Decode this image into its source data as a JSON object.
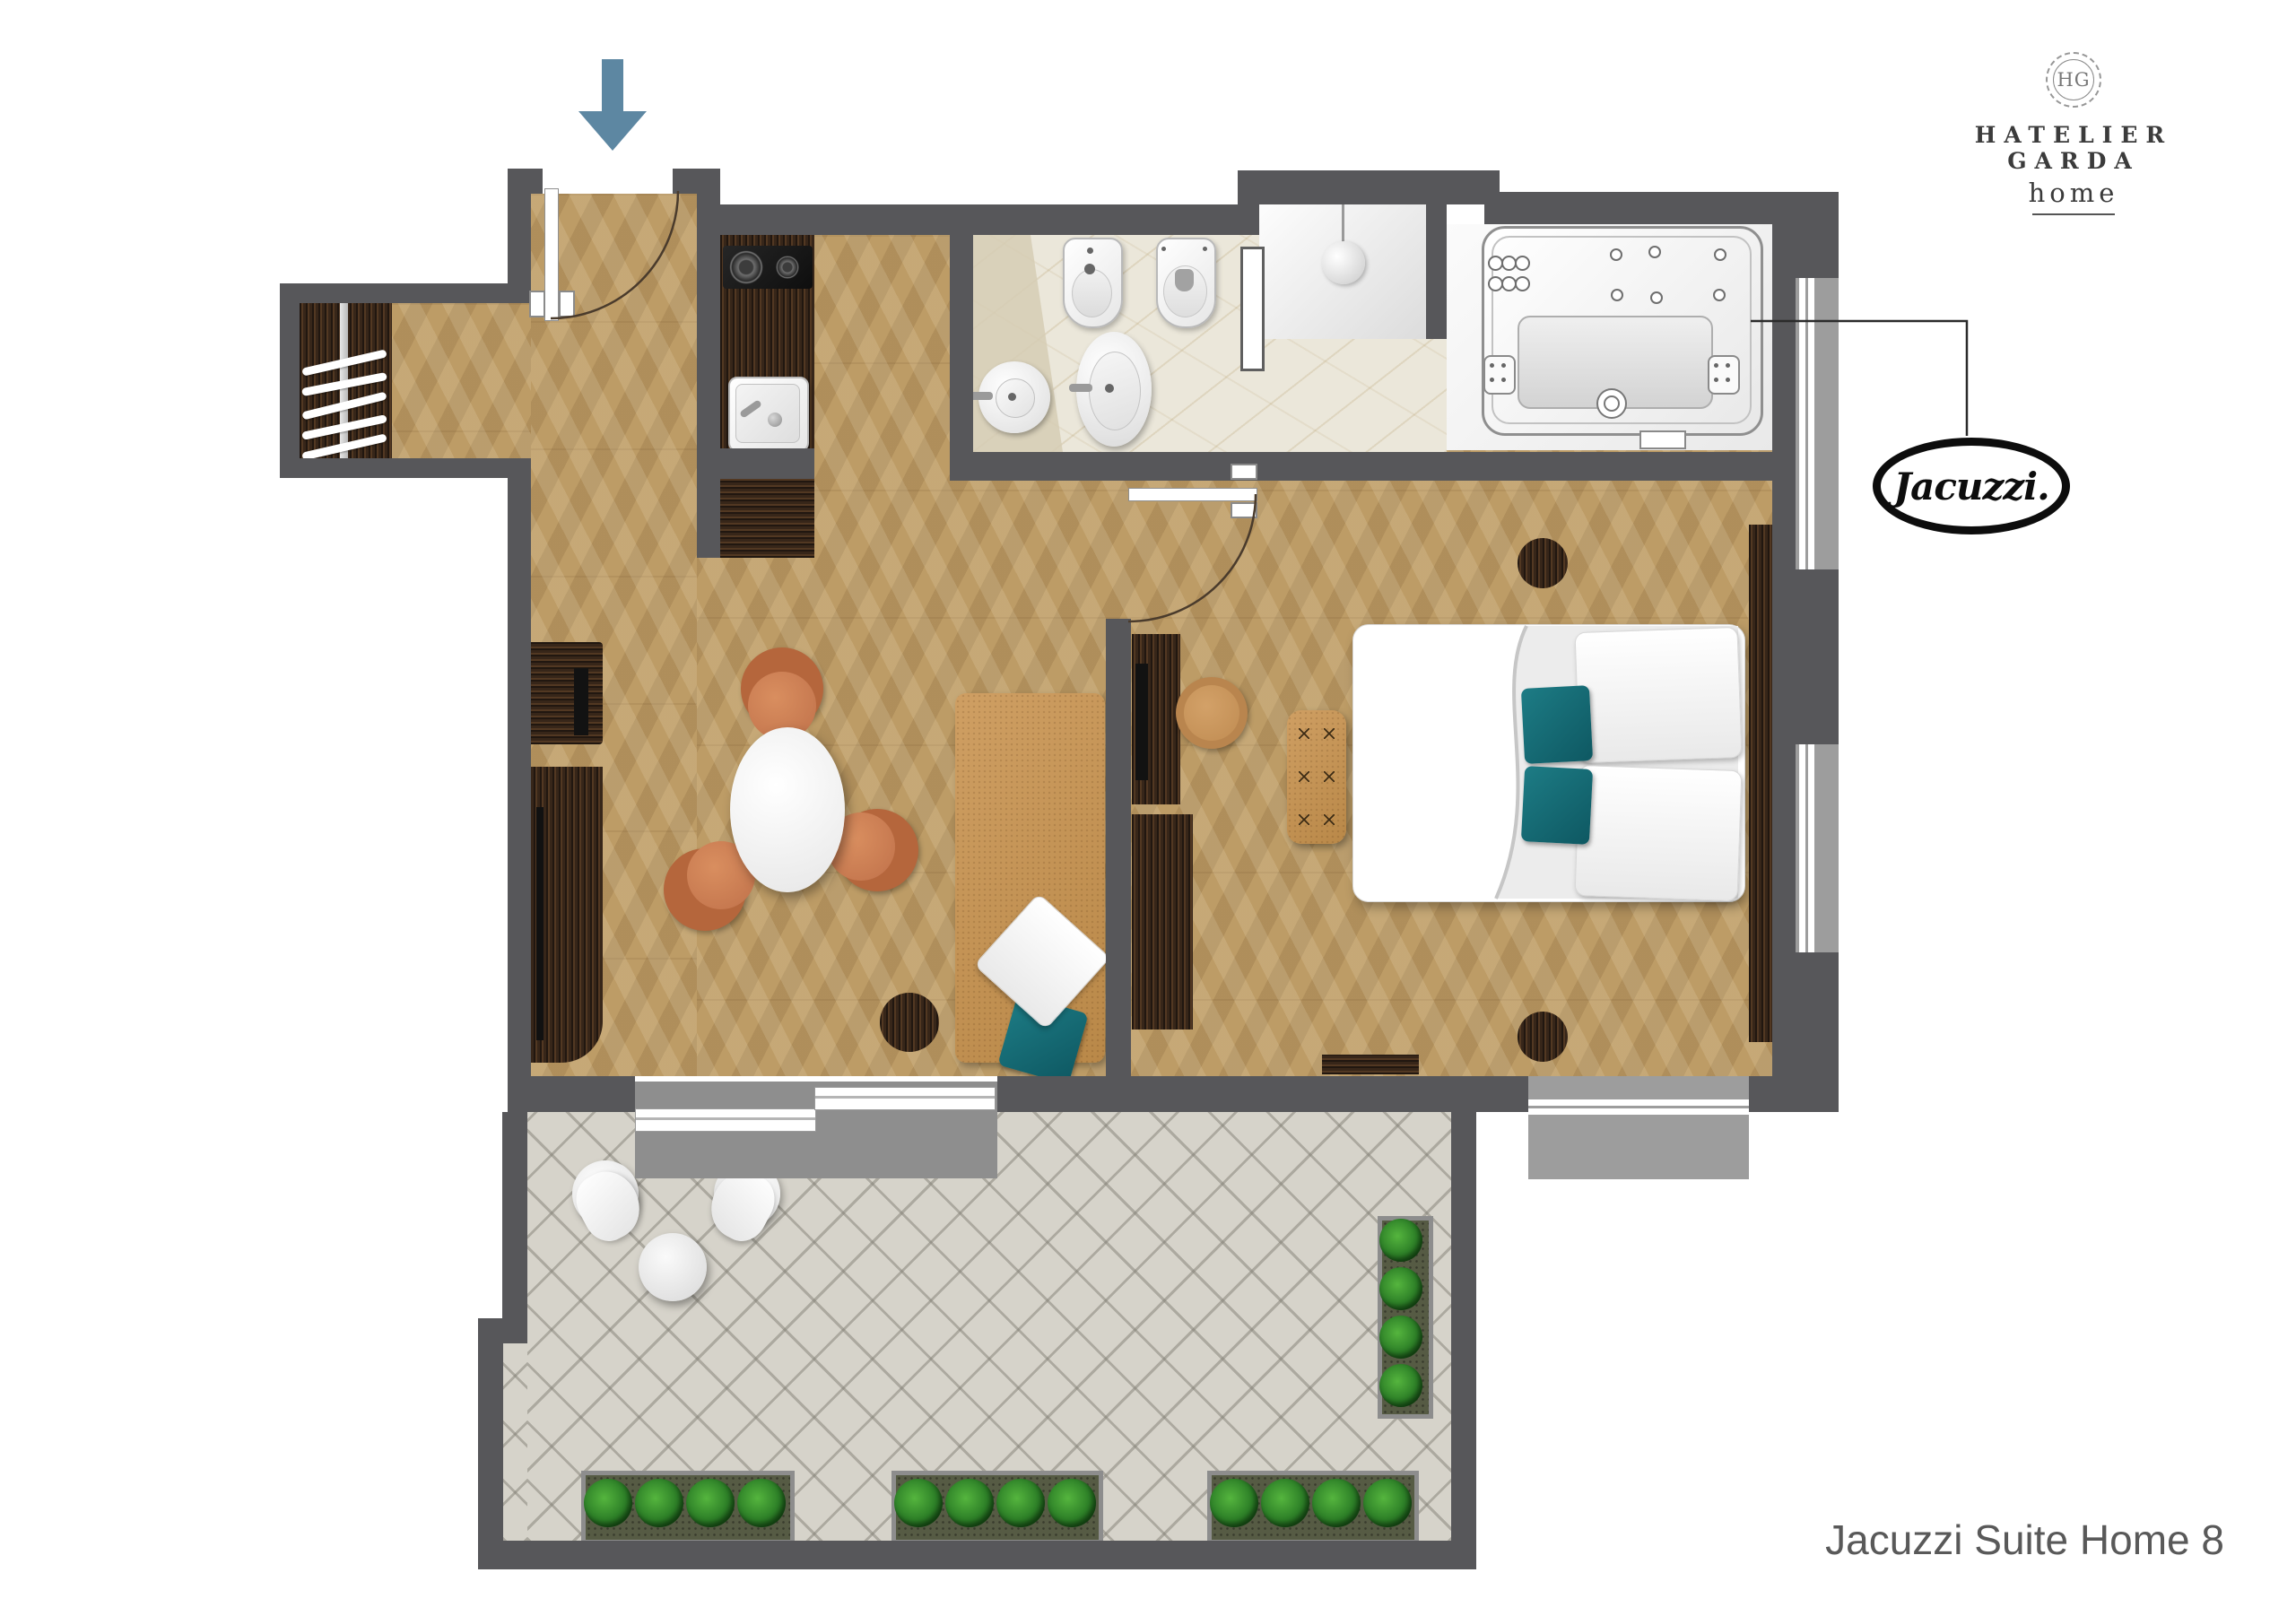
{
  "branding": {
    "monogram": "HG",
    "name": "HATELIER GARDA",
    "tagline": "home"
  },
  "jacuzzi_logo": {
    "text": "Jacuzzi."
  },
  "caption": {
    "text": "Jacuzzi Suite Home 8"
  },
  "icons": {
    "entrance_arrow": "arrow-down",
    "shower_head": "shower-head",
    "coat_hanger": "hanger"
  },
  "colors": {
    "wall": "#57575a",
    "wall_light": "#8e8e8e",
    "window_sill": "#9d9d9d",
    "wood_floor": "#bd9c66",
    "dark_wood": "#35251a",
    "marble": "#ebe7da",
    "terrace_tile": "#d6d3ca",
    "terracotta_chair": "#c0714a",
    "tan_leather": "#c79a5f",
    "teal_pillow": "#166b76",
    "plant_green": "#2e8128",
    "entrance_arrow_blue": "#5d87a2",
    "brand_text": "#3b3b3b",
    "caption_text": "#595959",
    "jacuzzi_logo_black": "#0d0d0d"
  }
}
